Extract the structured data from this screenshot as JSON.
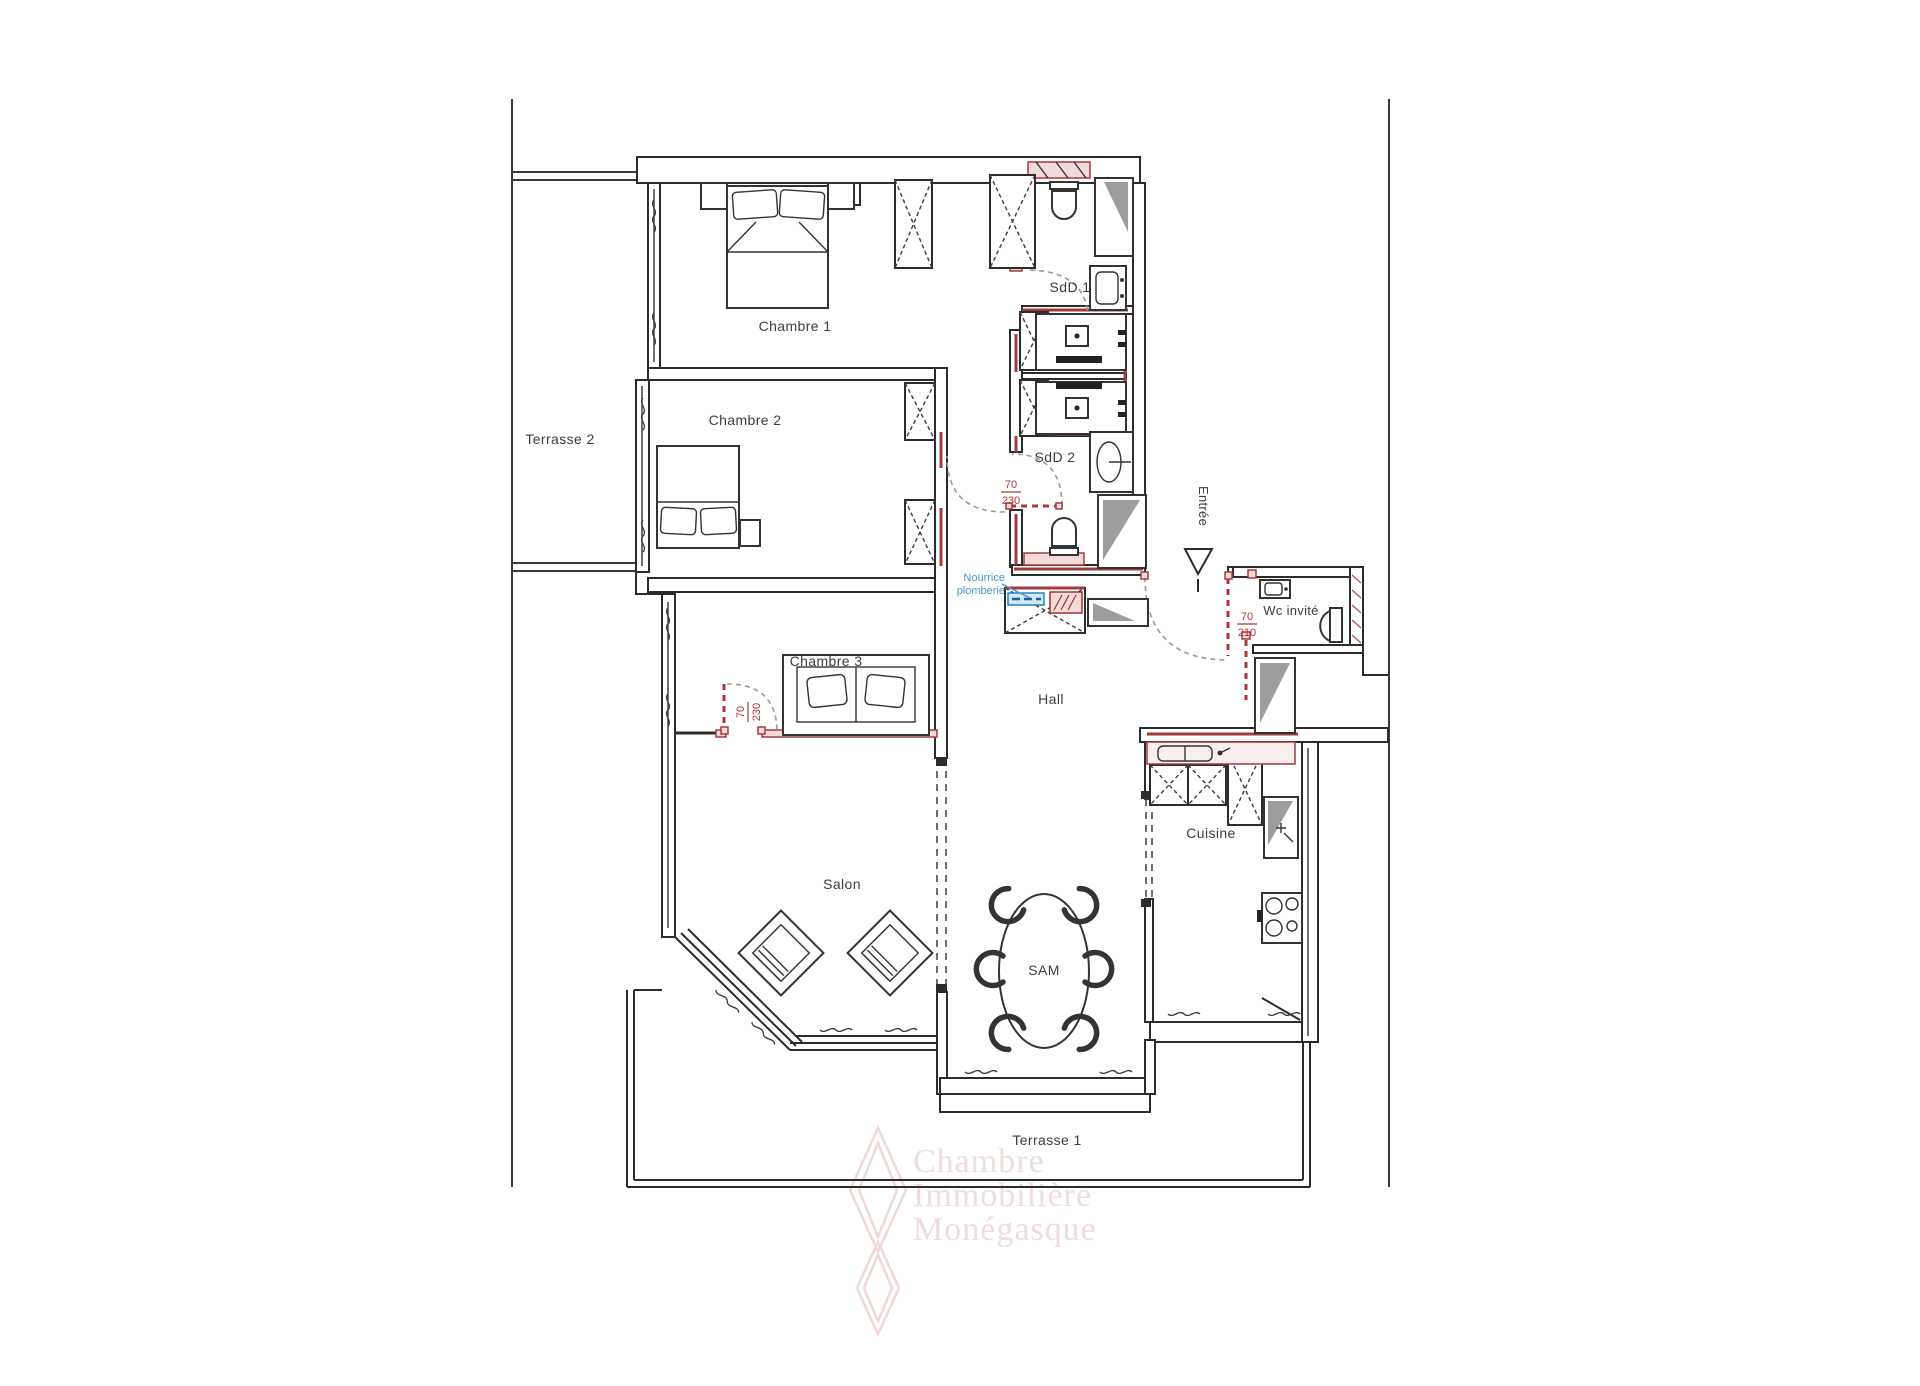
{
  "colors": {
    "wall": "#2c2c2c",
    "red_accent": "#a03c3c",
    "red_fill": "#f2dada",
    "red_text": "#b23434",
    "blue_text": "#4796c9",
    "blue_panel_fill": "#cfe9f8",
    "blue_panel_stroke": "#2d7fb5",
    "gray_panel": "#9d9d9d",
    "label_text": "#3d3d3d",
    "watermark_pink": "#f0dcdc"
  },
  "rooms": {
    "terrasse2": {
      "label": "Terrasse 2"
    },
    "chambre1": {
      "label": "Chambre 1"
    },
    "chambre2": {
      "label": "Chambre 2"
    },
    "chambre3": {
      "label": "Chambre 3"
    },
    "sdd1": {
      "label": "SdD 1"
    },
    "sdd2": {
      "label": "SdD 2"
    },
    "hall": {
      "label": "Hall"
    },
    "wc_invite": {
      "label": "Wc invité"
    },
    "salon": {
      "label": "Salon"
    },
    "sam": {
      "label": "SAM"
    },
    "cuisine": {
      "label": "Cuisine"
    },
    "terrasse1": {
      "label": "Terrasse 1"
    }
  },
  "annotations": {
    "entree": "Entrée",
    "nourrice_line1": "Nourrice",
    "nourrice_line2": "plomberie"
  },
  "door_dimensions": {
    "sdd2": {
      "width": "70",
      "height": "230"
    },
    "wc": {
      "width": "70",
      "height": "210"
    },
    "chambre3": {
      "width": "70",
      "height": "230"
    }
  },
  "watermark": {
    "line1": "Chambre",
    "line2": "Immobilière",
    "line3": "Monégasque"
  }
}
